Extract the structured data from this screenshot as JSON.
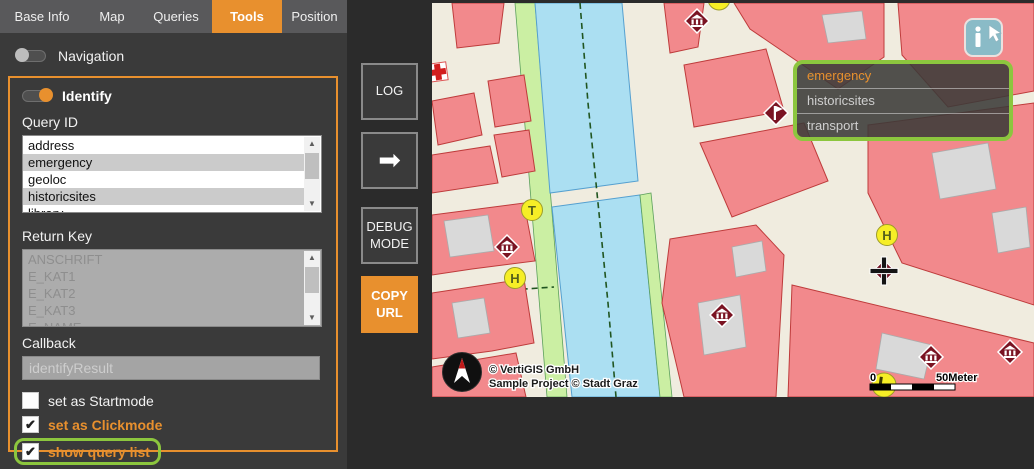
{
  "colors": {
    "accent": "#E8902E",
    "annotation_green": "#8CC63E",
    "panel_bg": "#3A3A3A"
  },
  "tabs": [
    {
      "label": "Base Info",
      "active": false
    },
    {
      "label": "Map",
      "active": false
    },
    {
      "label": "Queries",
      "active": false
    },
    {
      "label": "Tools",
      "active": true
    },
    {
      "label": "Position",
      "active": false
    }
  ],
  "panel": {
    "navigation": {
      "label": "Navigation",
      "on": false
    },
    "identify": {
      "label": "Identify",
      "on": true,
      "query_id": {
        "label": "Query ID",
        "items": [
          {
            "label": "address",
            "selected": false
          },
          {
            "label": "emergency",
            "selected": true
          },
          {
            "label": "geoloc",
            "selected": false
          },
          {
            "label": "historicsites",
            "selected": true
          },
          {
            "label": "library",
            "selected": false
          }
        ]
      },
      "return_key": {
        "label": "Return Key",
        "disabled": true,
        "items": [
          "ANSCHRIFT",
          "E_KAT1",
          "E_KAT2",
          "E_KAT3",
          "E_NAME"
        ]
      },
      "callback": {
        "label": "Callback",
        "value": "identifyResult"
      },
      "checkboxes": [
        {
          "label": "set as Startmode",
          "checked": false,
          "style": "normal",
          "highlighted": false
        },
        {
          "label": "set as Clickmode",
          "checked": true,
          "style": "accent",
          "highlighted": false
        },
        {
          "label": "show query list",
          "checked": true,
          "style": "accent",
          "highlighted": true
        }
      ]
    }
  },
  "toolbar": {
    "log_label": "LOG",
    "arrow_glyph": "➡",
    "debug_label": "DEBUG MODE",
    "copy_label": "COPY URL"
  },
  "map": {
    "query_overlay": {
      "items": [
        {
          "label": "emergency",
          "active": true
        },
        {
          "label": "historicsites",
          "active": false
        },
        {
          "label": "transport",
          "active": false
        }
      ]
    },
    "attribution_line1": "© VertiGIS GmbH",
    "attribution_line2": "Sample Project © Stadt Graz",
    "scalebar": {
      "start": "0",
      "end": "50Meter"
    },
    "markers": {
      "t": "T",
      "h1": "H",
      "h2": "H"
    }
  }
}
